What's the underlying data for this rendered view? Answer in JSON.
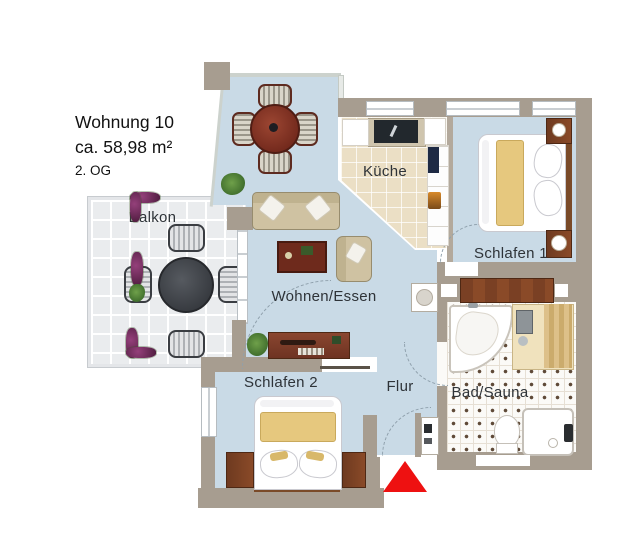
{
  "info_block": {
    "name": "Wohnung 10",
    "area": "ca. 58,98 m²",
    "floor": "2. OG"
  },
  "rooms": {
    "balkon": "Balkon",
    "kueche": "Küche",
    "schlafen1": "Schlafen 1",
    "wohnen_essen": "Wohnen/Essen",
    "schlafen2": "Schlafen 2",
    "flur": "Flur",
    "bad_sauna": "Bad/Sauna"
  },
  "entrance": {
    "marker": "red-triangle"
  },
  "colors": {
    "wall": "#a79d90",
    "floor_main": "#c9dae6",
    "floor_kitchen": "#ebdfc5",
    "floor_bath": "#faf9f6",
    "floor_balcony": "#eaecee",
    "entrance_marker": "#ee1111",
    "wood": "#7a4a2a",
    "blanket": "#e6c87e"
  }
}
